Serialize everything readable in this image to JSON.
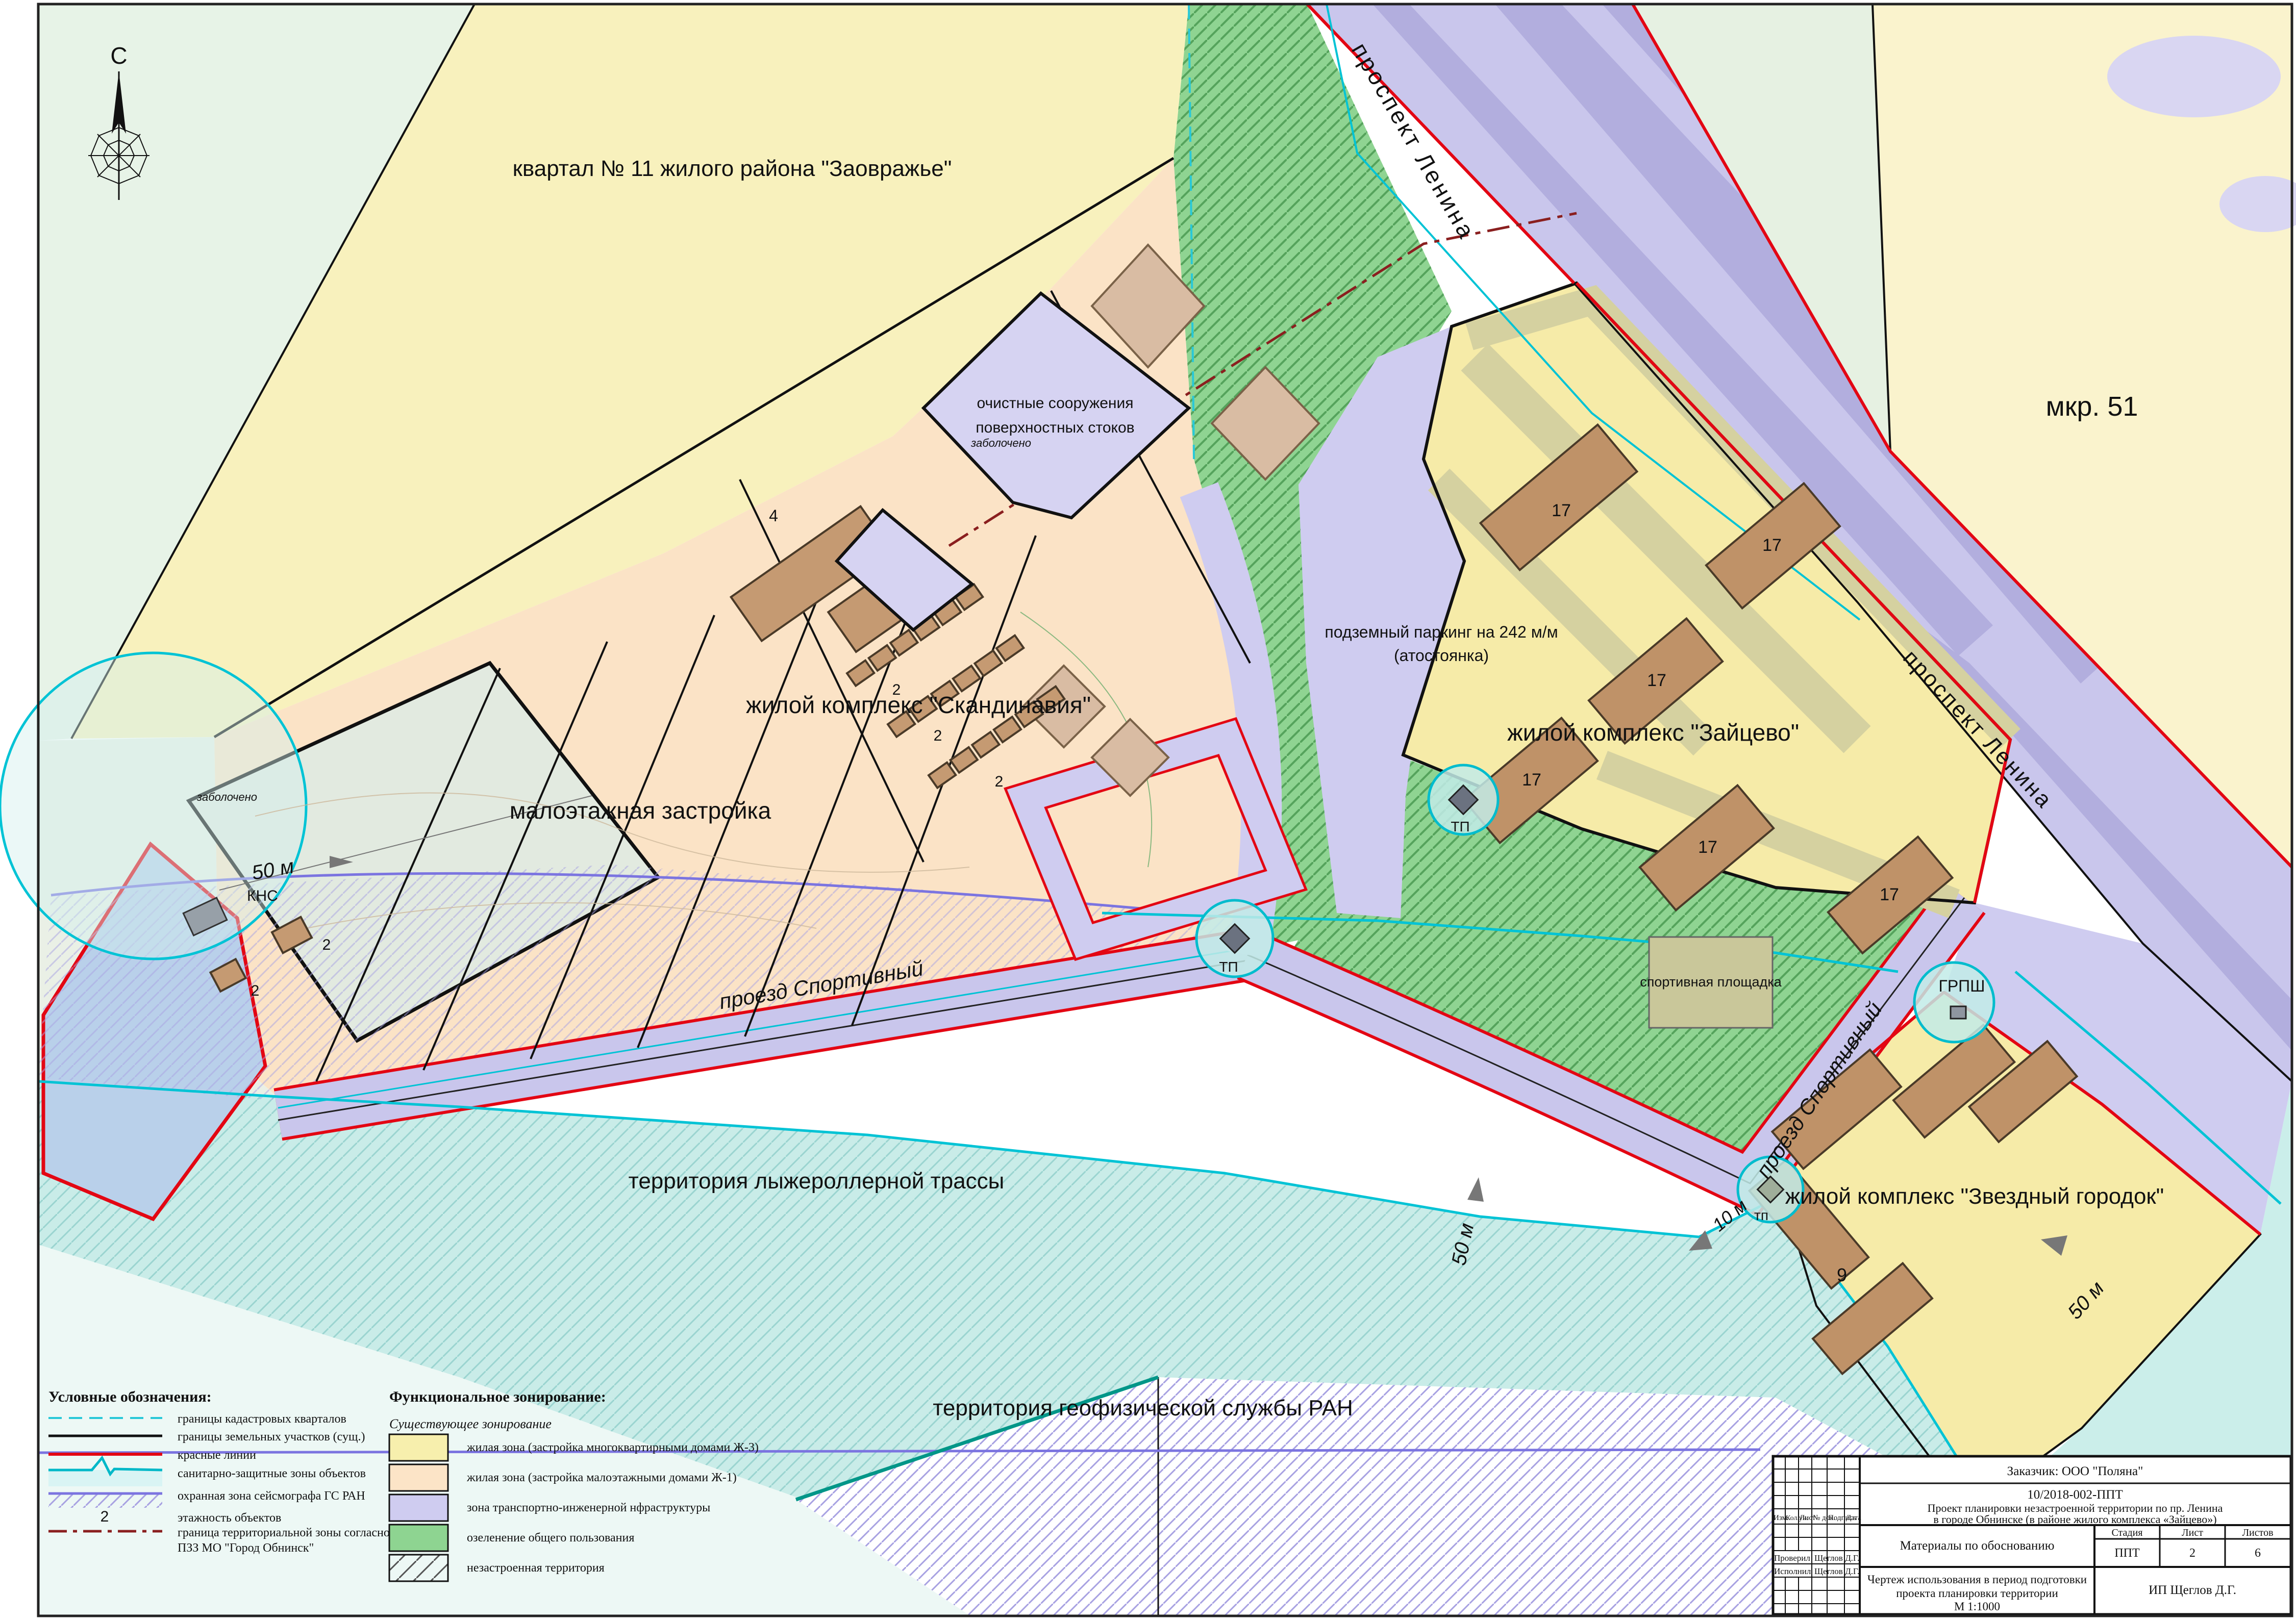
{
  "colors": {
    "zone_residential_multi": "#f7efad",
    "zone_residential_low": "#fce4c7",
    "zone_transport": "#c9c6ec",
    "zone_green": "#8fd492",
    "red_line": "#e30613",
    "cadastral_line": "#28c8d8",
    "sanitary_line": "#00b8c8",
    "seismograph_line": "#7b74e0",
    "territorial_line": "#8a1f1f",
    "building": "#bf9268"
  },
  "map": {
    "compass_label": "С",
    "labels": {
      "kvartal11": "квартал № 11 жилого района \"Заовражье\"",
      "mkr51": "мкр. 51",
      "prospekt_lenina": "проспект Ленина",
      "ochistnye_1": "очистные сооружения",
      "ochistnye_2": "поверхностных стоков",
      "skandinavia": "жилой комплекс \"Скандинавия\"",
      "maloetazhnaya": "малоэтажная застройка",
      "parking_1": "подземный паркинг на 242 м/м",
      "parking_2": "(атостоянка)",
      "zaytsevo": "жилой комплекс \"Зайцево\"",
      "proezd_sportivny": "проезд Спортивный",
      "lyzherollernaya": "территория лыжероллерной трассы",
      "geofizicheskaya": "территория геофизической службы РАН",
      "zvezdny": "жилой комплекс \"Звездный городок\"",
      "sportploshchadka": "спортивная площадка",
      "zabolocheno": "заболочено",
      "kns": "КНС",
      "tp": "ТП",
      "tp_small": "тп",
      "grpsh": "ГРПШ",
      "dist50": "50 м",
      "dist10": "10 м",
      "floors17": "17",
      "floors9": "9",
      "floors4": "4",
      "floors2": "2"
    }
  },
  "legend": {
    "title": "Условные обозначения:",
    "items": [
      {
        "label": "границы кадастровых кварталов"
      },
      {
        "label": "границы земельных участков (сущ.)"
      },
      {
        "label": "красные линии"
      },
      {
        "label": "санитарно-защитные зоны объектов"
      },
      {
        "label": "охранная зона сейсмографа ГС РАН"
      },
      {
        "symbol": "2",
        "label": "этажность объектов"
      },
      {
        "label": "граница территориальной зоны согласно",
        "label2": "ПЗЗ МО \"Город Обнинск\""
      }
    ]
  },
  "zoning": {
    "title": "Функциональное зонирование:",
    "subtitle": "Существующее зонирование",
    "items": [
      {
        "label": "жилая зона (застройка многоквартирными домами Ж-3)",
        "color": "#f7efad"
      },
      {
        "label": "жилая зона (застройка малоэтажными домами Ж-1)",
        "color": "#fce4c7"
      },
      {
        "label": "зона транспортно-инженерной нфраструктуры",
        "color": "#cfccf0"
      },
      {
        "label": "озеленение общего пользования",
        "color": "#8ed491"
      },
      {
        "label": "незастроенная территория",
        "color": "hatch"
      }
    ]
  },
  "titleblock": {
    "customer": "Заказчик: ООО \"Поляна\"",
    "code": "10/2018-002-ППТ",
    "project_line1": "Проект планировки незастроенной территории по пр. Ленина",
    "project_line2": "в городе Обнинске (в районе жилого комплекса «Зайцево»)",
    "materials": "Материалы по обоснованию",
    "stage_label": "Стадия",
    "sheet_label": "Лист",
    "sheets_label": "Листов",
    "stage": "ППТ",
    "sheet": "2",
    "sheets": "6",
    "drawing_title_line1": "Чертеж использования в период подготовки",
    "drawing_title_line2": "проекта планировки территории",
    "drawing_scale": "М 1:1000",
    "org": "ИП Щеглов Д.Г.",
    "col_izm": "Изм.",
    "col_koluch": "Кол.уч.",
    "col_list": "Лист",
    "col_dok": "№ док.",
    "col_podpis": "Подпись",
    "col_data": "Дата",
    "checked_label": "Проверил",
    "checked_name": "Щеглов Д.Г.",
    "author_label": "Исполнил",
    "author_name": "Щеглов Д.Г."
  }
}
